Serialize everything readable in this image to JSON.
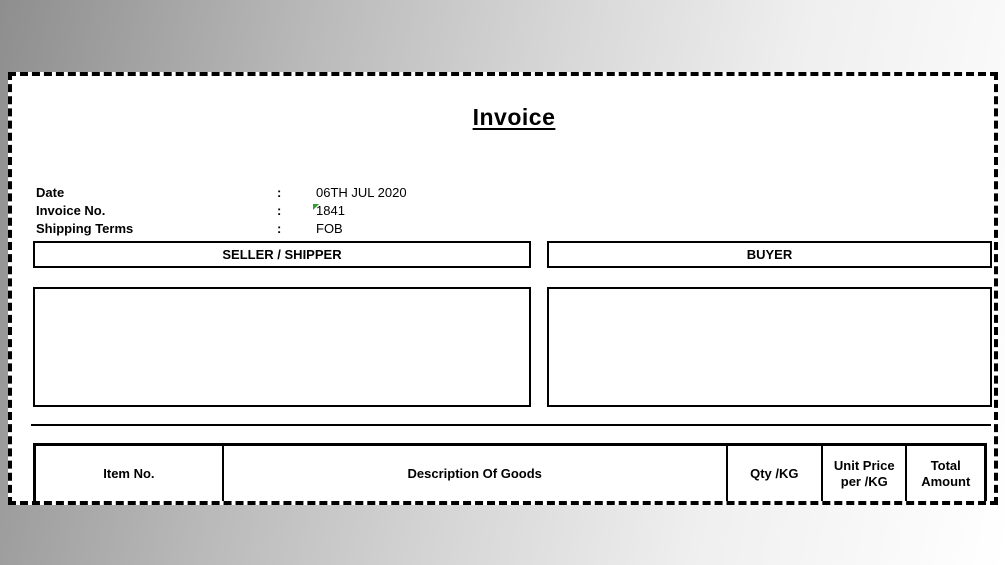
{
  "invoice": {
    "title": "Invoice",
    "info": [
      {
        "label": "Date",
        "colon": ":",
        "value": "06TH JUL 2020"
      },
      {
        "label": "Invoice No.",
        "colon": ":",
        "value": "1841"
      },
      {
        "label": "Shipping Terms",
        "colon": ":",
        "value": "FOB"
      }
    ],
    "sections": {
      "seller_header": "SELLER / SHIPPER",
      "buyer_header": "BUYER"
    },
    "table_headers": {
      "item_no": "Item No.",
      "description": "Description Of Goods",
      "qty": "Qty /KG",
      "unit_price_line1": "Unit Price",
      "unit_price_line2": "per /KG",
      "total_line1": "Total",
      "total_line2": "Amount"
    },
    "flags": {
      "invoice_no_flag": "number-stored-as-text green corner triangle",
      "flag_color": "#2f9e2f"
    },
    "colors": {
      "border": "#000000",
      "paper": "#ffffff",
      "backdrop_dark": "#8e8e8e",
      "backdrop_light": "#ffffff"
    }
  }
}
